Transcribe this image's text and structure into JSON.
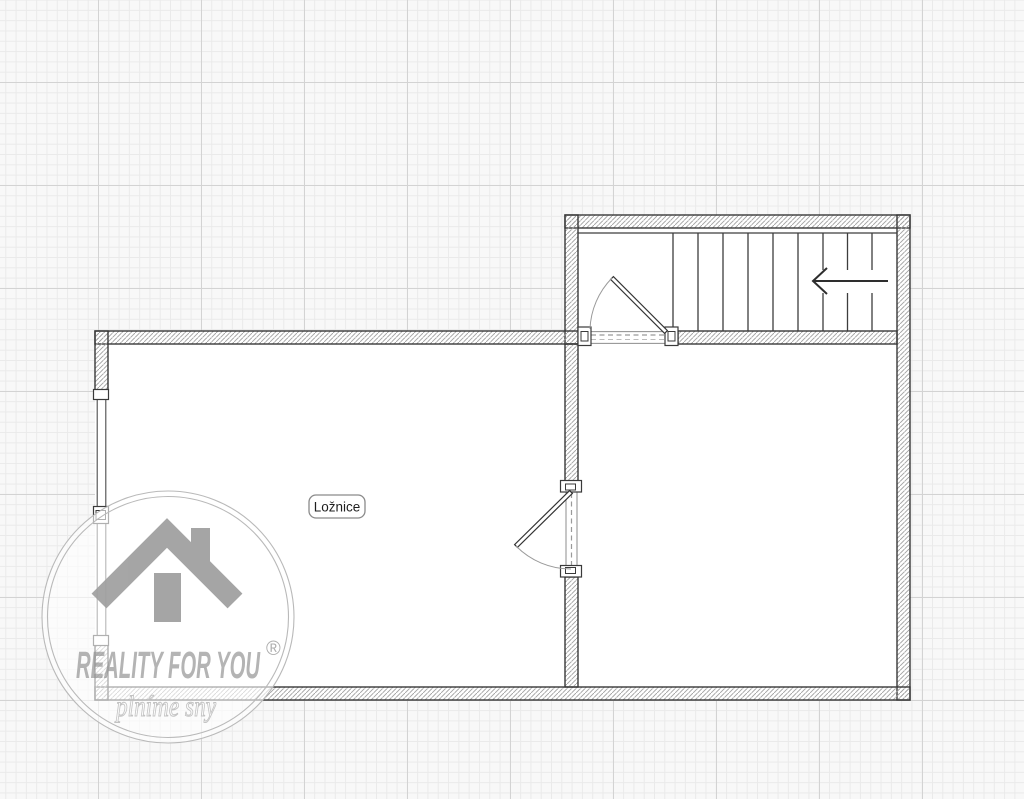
{
  "plan": {
    "type": "floor-plan",
    "room_label": "Ložnice",
    "stair_arrow_direction": "left",
    "stair_tread_count": 10,
    "doors": [
      "stair-room-door",
      "bedroom-door"
    ],
    "window_segments": 2
  },
  "watermark": {
    "brand": "REALITY FOR YOU",
    "registered_mark": "®",
    "tagline": "plníme sny",
    "icon": "house-icon"
  },
  "colors": {
    "paper": "#f8f8f8",
    "grid_minor": "#eaeaea",
    "grid_major": "#d3d3d3",
    "wall_outline": "#383838",
    "wall_hatch": "#a0a0a0",
    "watermark_gray": "#9e9e9e"
  }
}
